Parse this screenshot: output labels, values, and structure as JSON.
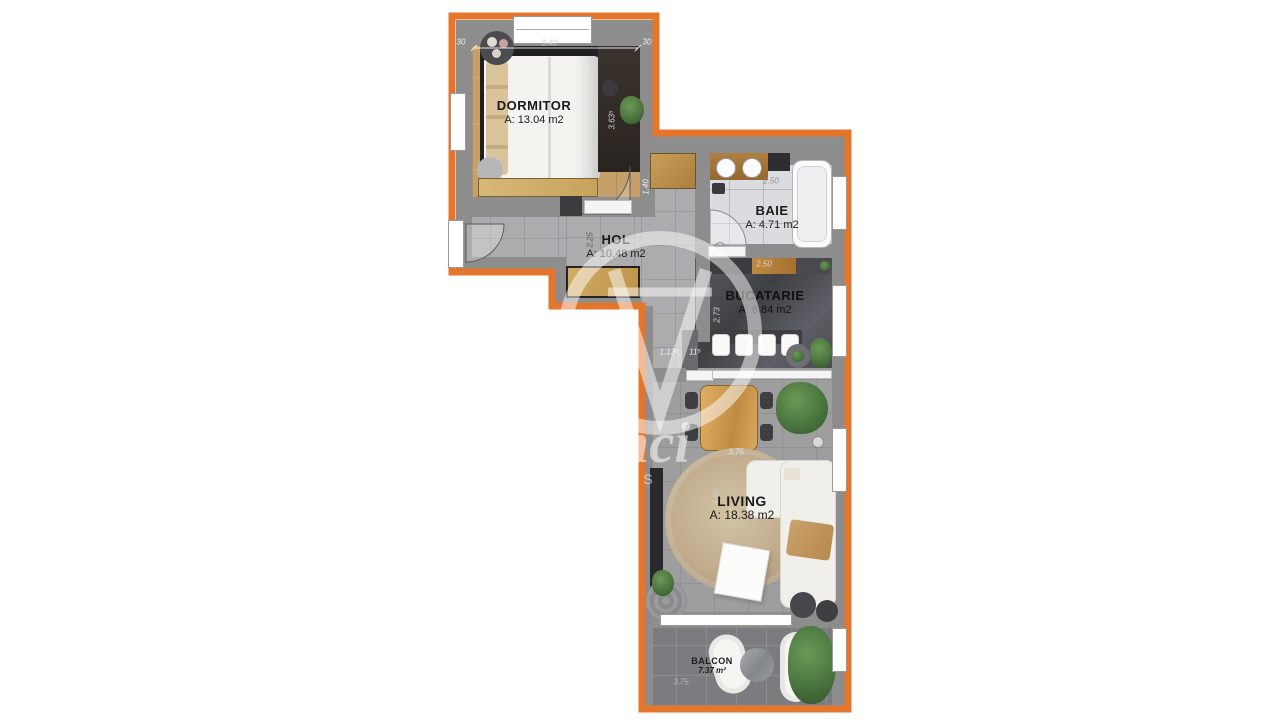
{
  "plan": {
    "type": "apartment-floor-plan",
    "outline_color": "#E6752C"
  },
  "watermark": {
    "brand": "daVinci",
    "suffix": "HOMES"
  },
  "rooms": [
    {
      "name": "DORMITOR",
      "area": "A: 13.04 m2"
    },
    {
      "name": "BAIE",
      "area": "A: 4.71 m2"
    },
    {
      "name": "HOL",
      "area": "A: 10.48 m2"
    },
    {
      "name": "BUCATARIE",
      "area": "A: 6.84 m2"
    },
    {
      "name": "LIVING",
      "area": "A: 18.38 m2"
    },
    {
      "name": "BALCON",
      "area": "7.37 m²"
    }
  ],
  "dimensions": {
    "bedroom_left_wall": "30",
    "bedroom_width": "3.40",
    "bedroom_right_wall": "30",
    "bedroom_depth": "3.63⁵",
    "bedroom_door": "1.40",
    "hol_width": "2.25",
    "baie_width": "2.50",
    "bucatarie_width": "2.50",
    "bucatarie_depth": "2.73",
    "opening_left": "1.13⁵",
    "opening_right": "11⁵",
    "living_width": "3.75",
    "living_depth": "4.60",
    "balcon_width": "3.75"
  }
}
